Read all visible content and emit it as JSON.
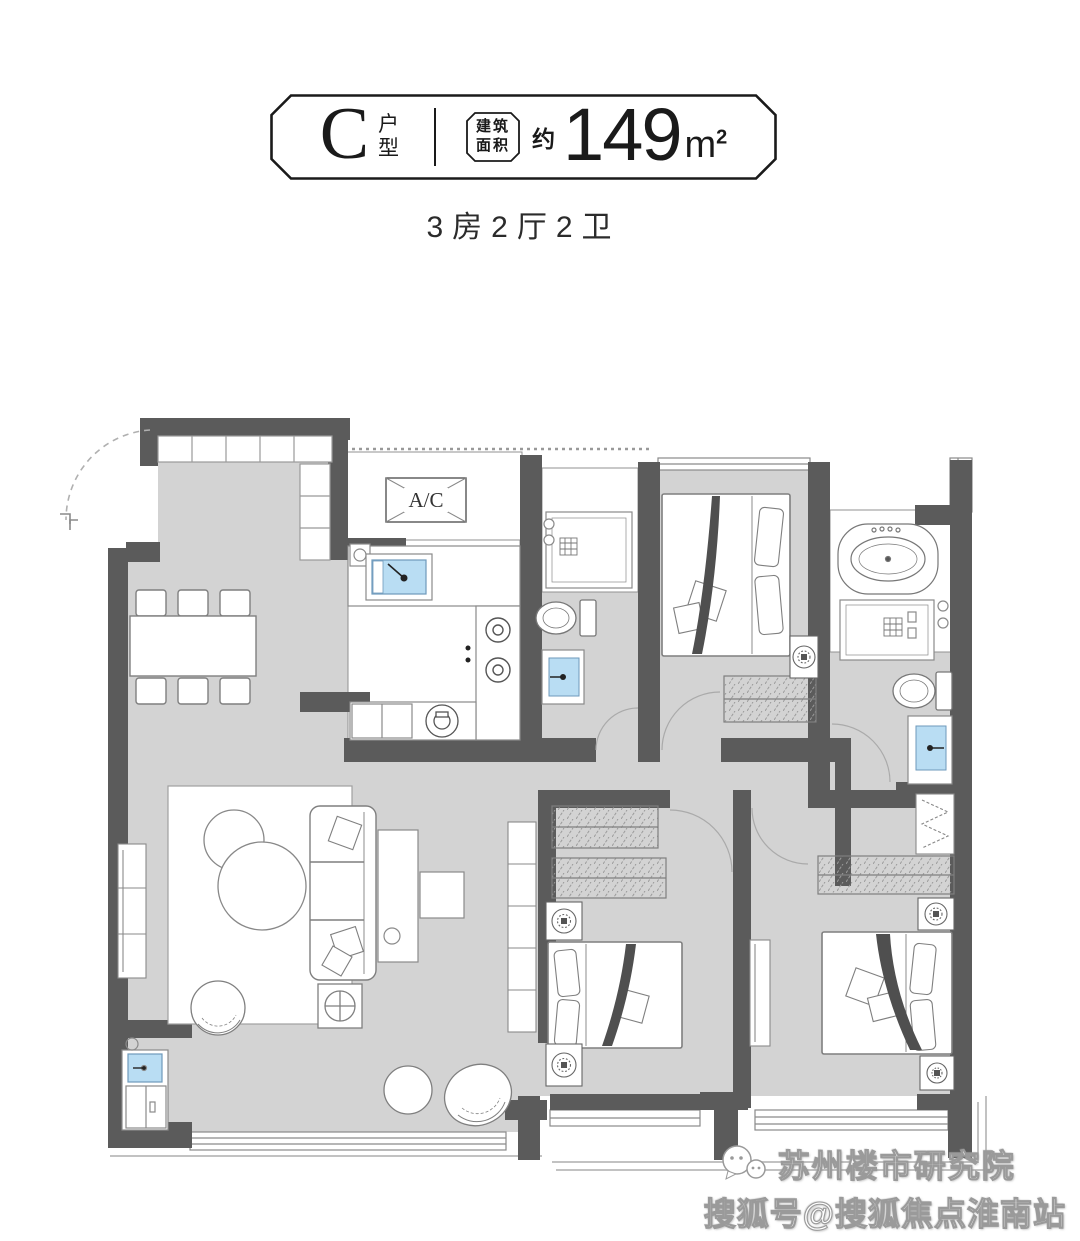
{
  "header": {
    "type_letter": "C",
    "type_label_top": "户",
    "type_label_bottom": "型",
    "area_badge_line1": "建筑",
    "area_badge_line2": "面积",
    "area_prefix": "约",
    "area_value": "149",
    "area_unit": "m",
    "area_unit_sup": "2",
    "subtitle": "3房2厅2卫"
  },
  "plan": {
    "ac_label": "A/C"
  },
  "watermark": {
    "line1": "苏州楼市研究院",
    "line2": "搜狐号@搜狐焦点淮南站"
  },
  "colors": {
    "wall": "#5b5b5b",
    "floor": "#d3d3d3",
    "sink_blue": "#b9ddf3",
    "ink": "#1a1a1a"
  }
}
